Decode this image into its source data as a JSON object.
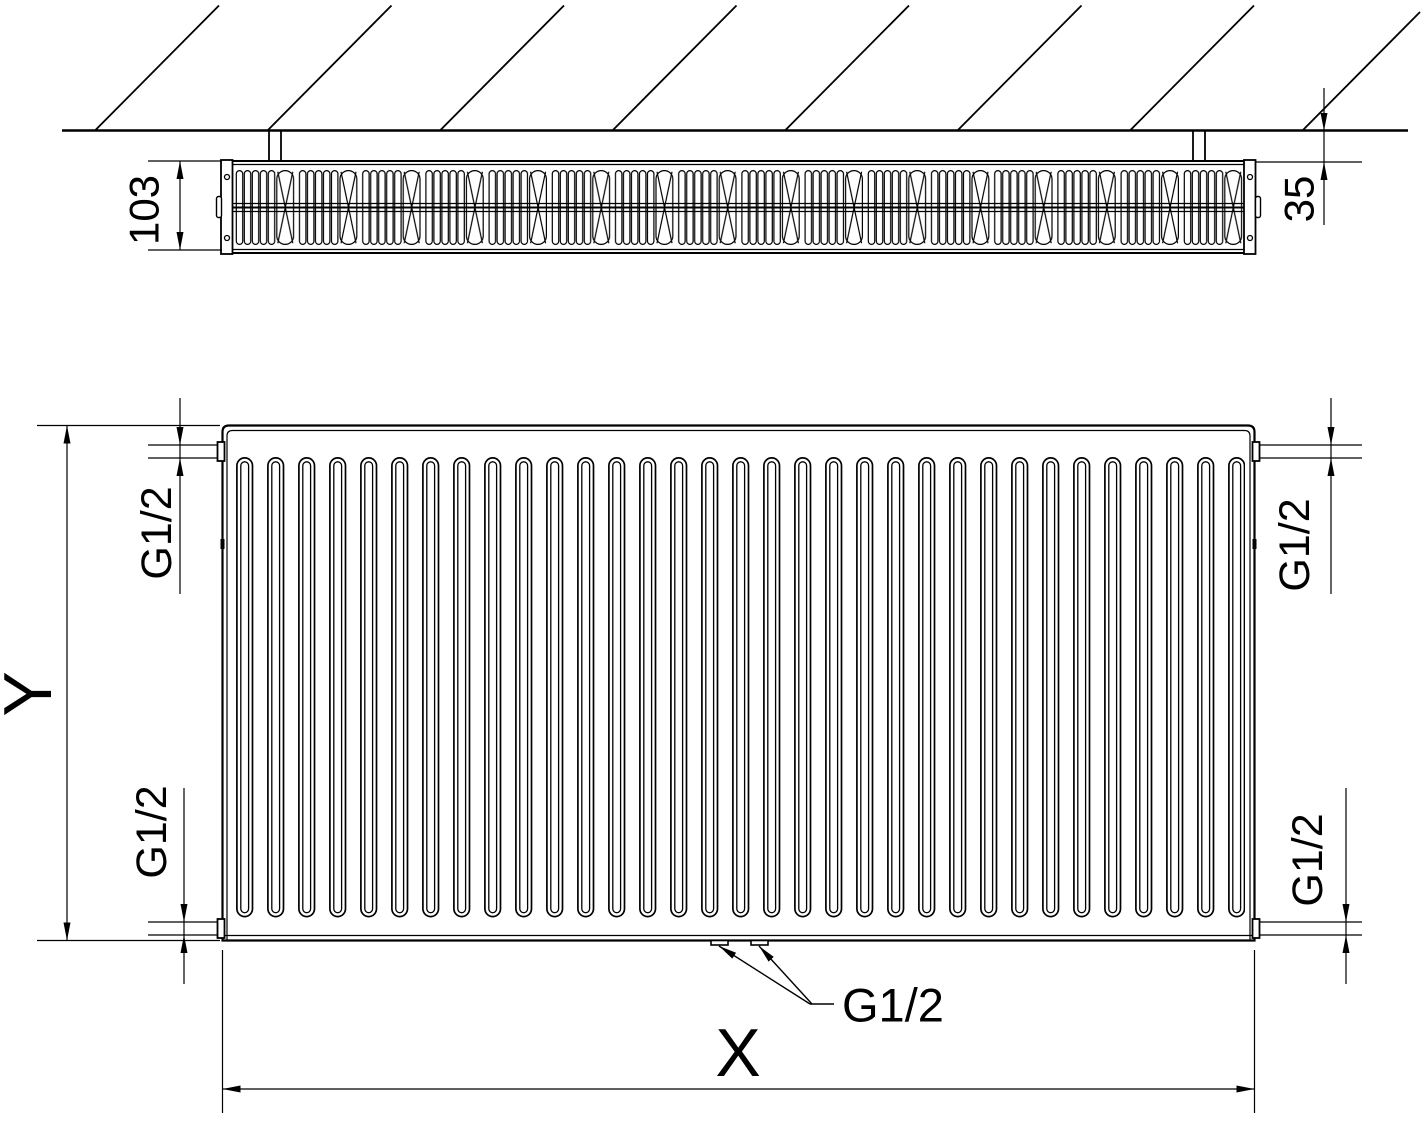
{
  "drawing": {
    "background": "#ffffff",
    "line_color": "#000000",
    "labels": {
      "depth": "103",
      "gap": "35",
      "height": "Y",
      "width": "X",
      "thread": "G1/2"
    }
  }
}
